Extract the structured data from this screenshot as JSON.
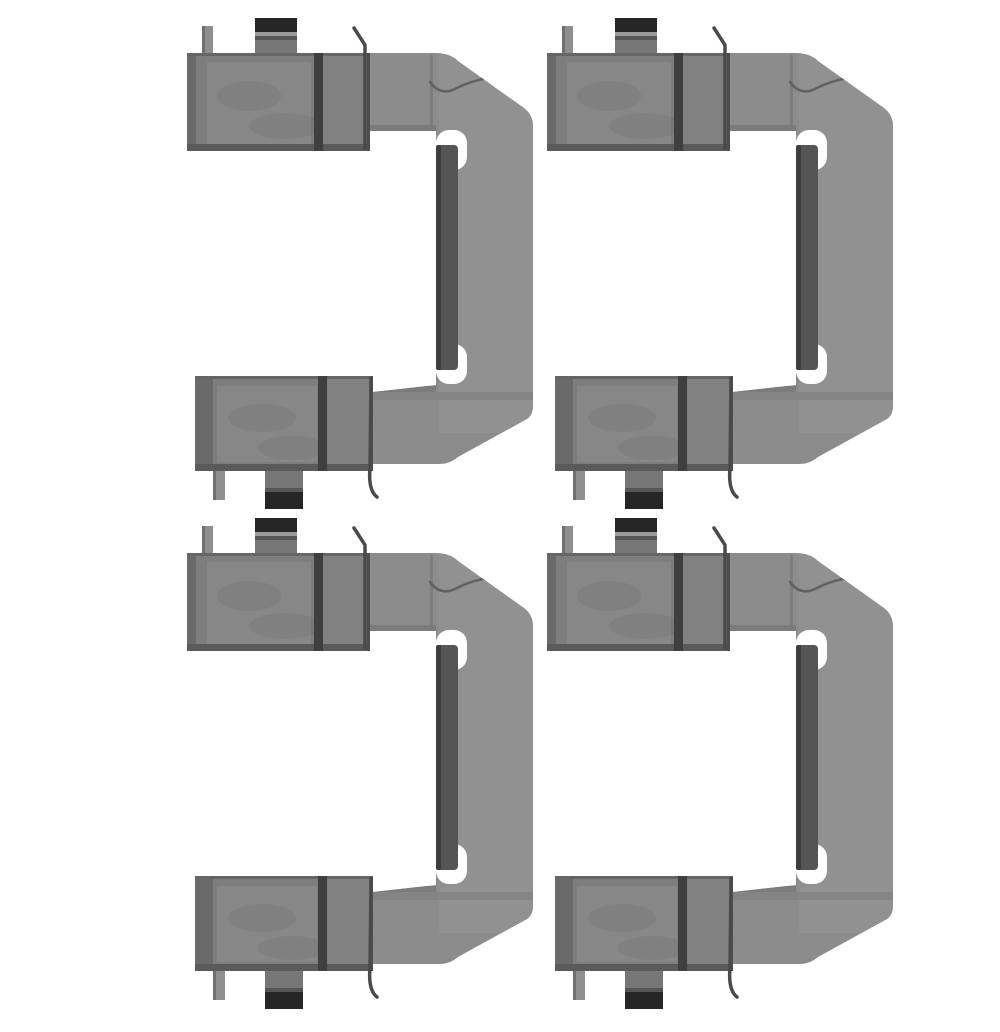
{
  "meta": {
    "content_type": "product-photo",
    "description": "Four identical stamped sheet-metal brake caliper fitting-kit clips (pad retainer springs) arranged in a 2 by 2 grid on a plain white background",
    "visible_text": "",
    "items_count": 4
  },
  "canvas": {
    "width": 1000,
    "height": 1000,
    "background": "#ffffff"
  },
  "grid": {
    "rows": 2,
    "cols": 2,
    "positions": [
      {
        "id": "clip-top-left",
        "x": 147,
        "y": 2
      },
      {
        "id": "clip-top-right",
        "x": 507,
        "y": 2
      },
      {
        "id": "clip-bottom-left",
        "x": 147,
        "y": 502
      },
      {
        "id": "clip-bottom-right",
        "x": 507,
        "y": 502
      }
    ]
  },
  "clip": {
    "name": "caliper-fitting-kit-clip",
    "width": 346,
    "height": 491,
    "colors": {
      "metal_base": "#8c8c8c",
      "metal_light": "#969696",
      "pad_face": "#7e7e7e",
      "pad_highlight": "#878787",
      "pad_right_section": "#828282",
      "pad_left_band": "#6a6a6a",
      "pad_top_line": "#666666",
      "pad_bottom_band": "#5a5a5a",
      "fold_line_dark": "#3f3f3f",
      "edge_line": "#4e4e4e",
      "inner_edge_soft": "#7a7a7a",
      "sheet_line": "#7d7d7d",
      "rail_dark": "#555555",
      "rail_edge": "#3e3e3e",
      "black_cap": "#262626",
      "cap_highlight": "#9a9a9a",
      "cap_shadow": "#565656",
      "tab_grey": "#8f8f8f",
      "tab_edge": "#707070",
      "tab_stem": "#777777",
      "wire": "#4a4a4a",
      "crease": "#616161",
      "notch_white": "#ffffff",
      "background": "#ffffff"
    }
  }
}
